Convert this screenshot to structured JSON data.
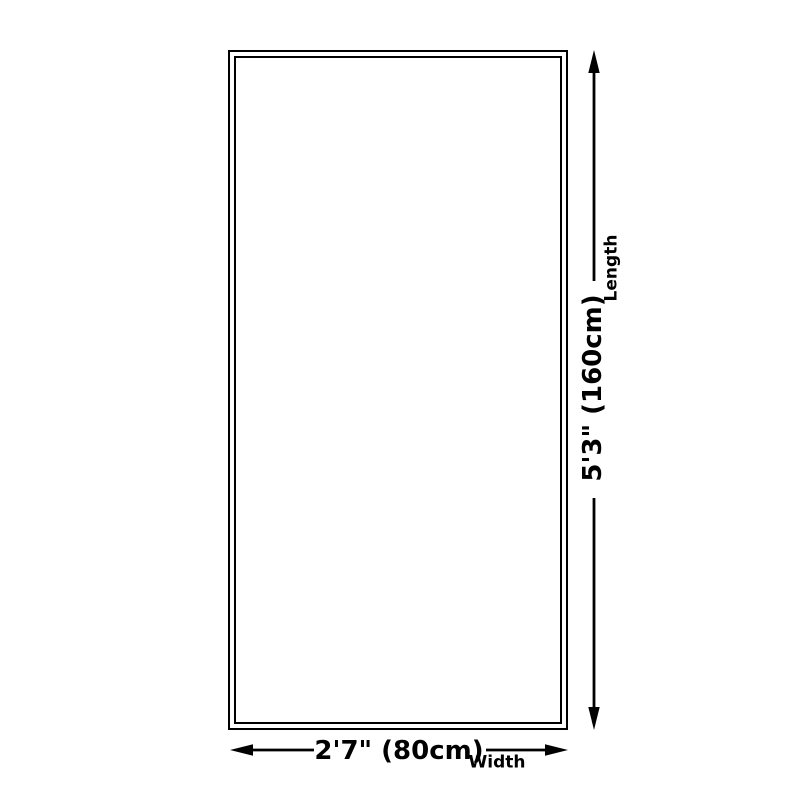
{
  "title": "Product size dimension diagram",
  "colors": {
    "line": "#000000",
    "background": "#ffffff",
    "text": "#000000"
  },
  "rug": {
    "length": {
      "label": "Length",
      "value": "5'3\" (160cm)"
    },
    "width": {
      "label": "Width",
      "value": "2'7\" (80cm)"
    }
  }
}
